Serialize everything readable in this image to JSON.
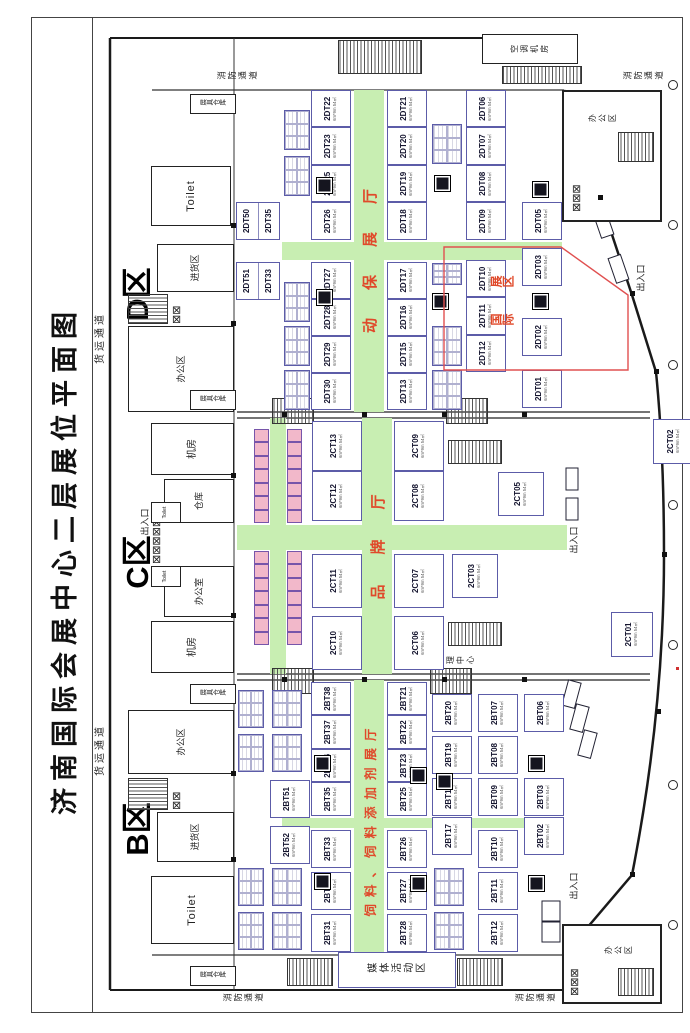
{
  "labels": {
    "title": "济南国际会展中心二层展位平面图",
    "zone_b": "B区",
    "zone_c": "C区",
    "zone_d": "D区",
    "hall_b": "饲料、饲料添加剂展厅",
    "hall_c": "品牌厅",
    "hall_d": "动保展厅",
    "intl_1": "国际",
    "intl_2": "展区",
    "fire_lane": "消防通道",
    "cargo_lane": "货运通道",
    "entrance": "出入口",
    "toilet": "Toilet",
    "office_area": "办公区",
    "office": "办公室",
    "machine_room": "机房",
    "warehouse": "仓库",
    "loading": "进货区",
    "booth_store": "展具仓库",
    "media_zone": "媒体活动区",
    "mgmt_center": "管理中心",
    "hvac_room": "空调机房",
    "booth_size": "6m*9m 54㎡"
  },
  "d_hall": {
    "pairs": [
      [
        "2DT51",
        "2DT33"
      ],
      [
        "2DT50",
        "2DT35"
      ]
    ],
    "row_a_l": [
      "2DT30",
      "2DT29",
      "2DT28",
      "2DT27"
    ],
    "row_a_r": [
      "2DT26",
      "2DT25",
      "2DT23",
      "2DT22"
    ],
    "row_b_l": [
      "2DT13",
      "2DT15",
      "2DT16",
      "2DT17"
    ],
    "row_b_r": [
      "2DT18",
      "2DT19",
      "2DT20",
      "2DT21"
    ],
    "row_c_l": [
      "2DT12",
      "2DT11",
      "2DT10"
    ],
    "row_c_r": [
      "2DT09",
      "2DT08",
      "2DT07",
      "2DT06"
    ],
    "row_d_l": [
      "2DT01",
      "2DT02"
    ],
    "row_d_r": [
      "2DT03",
      "2DT05"
    ]
  },
  "c_hall": {
    "row1_l": [
      "2CT10",
      "2CT11"
    ],
    "row1_r": [
      "2CT12",
      "2CT13"
    ],
    "row2_l": [
      "2CT06",
      "2CT07"
    ],
    "row2_r": [
      "2CT08",
      "2CT09"
    ],
    "mid_l": "2CT03",
    "mid_r": "2CT05",
    "wall_l": "2CT01",
    "wall_r": "2CT02"
  },
  "b_hall": {
    "upper": [
      "2BT52",
      "2BT51"
    ],
    "row_a_l": [
      "2BT31",
      "2BT32",
      "2BT33"
    ],
    "row_a_r": [
      "2BT35",
      "2BT36",
      "2BT37",
      "2BT38"
    ],
    "row_b_l": [
      "2BT28",
      "2BT27",
      "2BT26"
    ],
    "row_b_r": [
      "2BT25",
      "2BT23",
      "2BT22",
      "2BT21"
    ],
    "row_c_l": [
      "2BT17"
    ],
    "row_c_r": [
      "2BT18",
      "2BT19",
      "2BT20"
    ],
    "row_d_l": [
      "2BT12",
      "2BT11",
      "2BT10"
    ],
    "row_d_r": [
      "2BT09",
      "2BT08",
      "2BT07"
    ],
    "row_e_l": [
      "2BT02"
    ],
    "row_e_r": [
      "2BT03",
      "2BT06"
    ]
  }
}
